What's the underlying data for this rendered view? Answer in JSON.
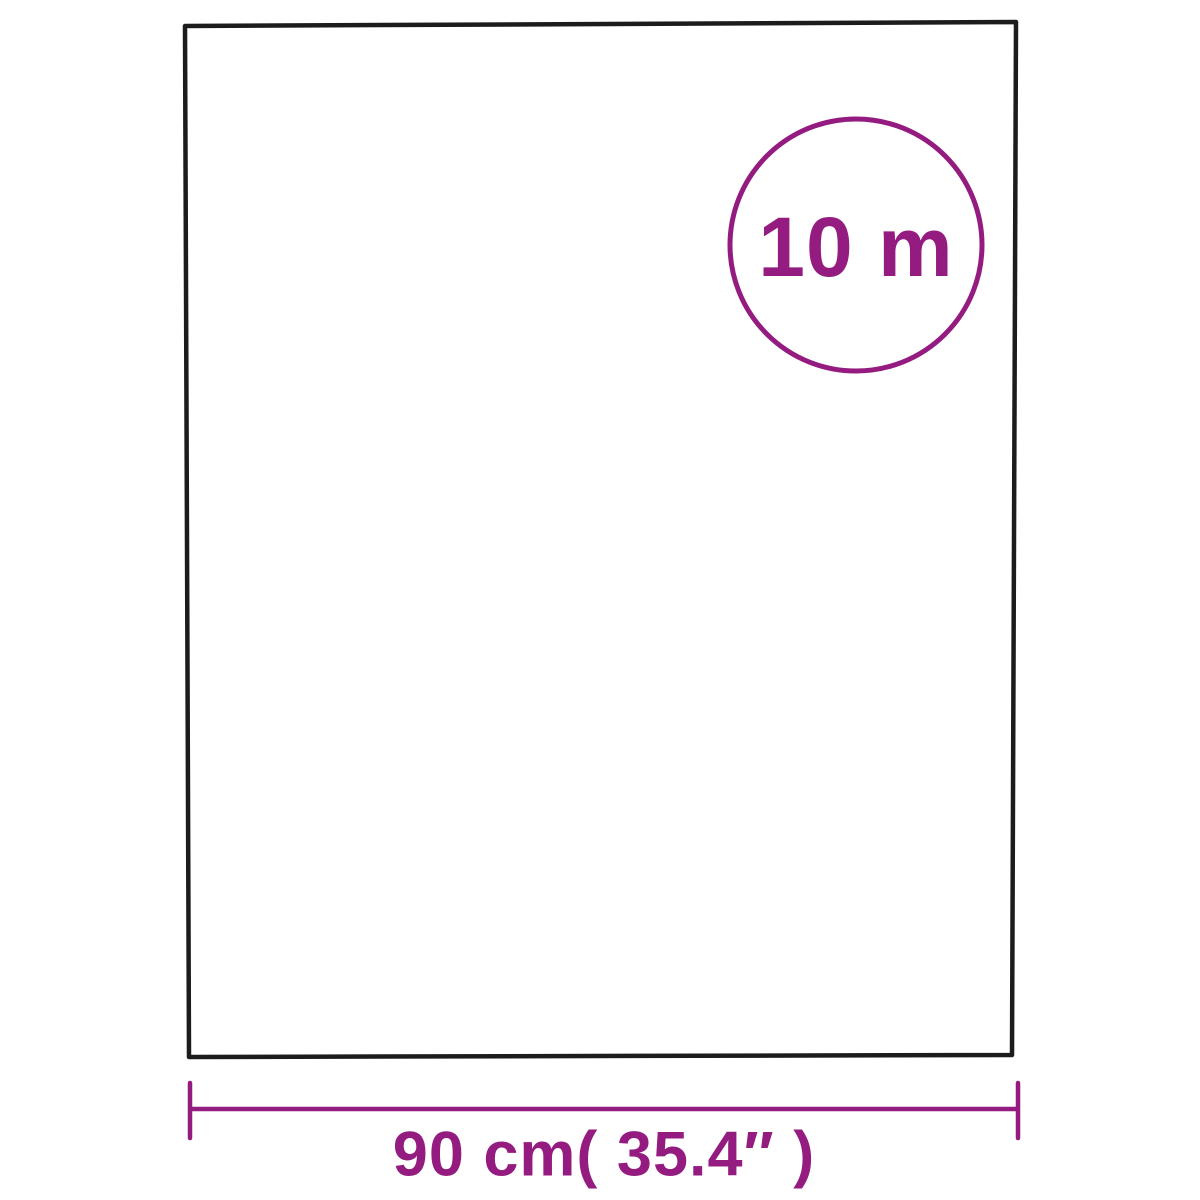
{
  "colors": {
    "background": "#ffffff",
    "sheet_outline": "#1c1c1c",
    "accent_purple": "#941b80"
  },
  "badge": {
    "label": "10 m"
  },
  "dimension": {
    "label": "90 cm( 35.4″ )"
  }
}
